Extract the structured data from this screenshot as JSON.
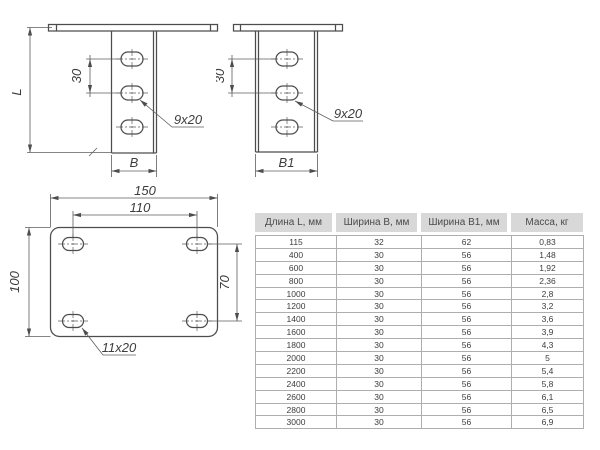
{
  "drawings": {
    "side": {
      "dim_length": "L",
      "dim_hole_spacing": "30",
      "dim_width": "B",
      "slot_size": "9x20"
    },
    "front": {
      "dim_hole_spacing": "30",
      "dim_width": "B1",
      "slot_size": "9x20"
    },
    "plan": {
      "dim_overall_width": "150",
      "dim_hole_span_h": "110",
      "dim_overall_height": "100",
      "dim_hole_span_v": "70",
      "slot_size": "11x20"
    }
  },
  "table": {
    "columns": [
      "Длина L, мм",
      "Ширина B, мм",
      "Ширина B1, мм",
      "Масса, кг"
    ],
    "rows": [
      [
        "115",
        "32",
        "62",
        "0,83"
      ],
      [
        "400",
        "30",
        "56",
        "1,48"
      ],
      [
        "600",
        "30",
        "56",
        "1,92"
      ],
      [
        "800",
        "30",
        "56",
        "2,36"
      ],
      [
        "1000",
        "30",
        "56",
        "2,8"
      ],
      [
        "1200",
        "30",
        "56",
        "3,2"
      ],
      [
        "1400",
        "30",
        "56",
        "3,6"
      ],
      [
        "1600",
        "30",
        "56",
        "3,9"
      ],
      [
        "1800",
        "30",
        "56",
        "4,3"
      ],
      [
        "2000",
        "30",
        "56",
        "5"
      ],
      [
        "2200",
        "30",
        "56",
        "5,4"
      ],
      [
        "2400",
        "30",
        "56",
        "5,8"
      ],
      [
        "2600",
        "30",
        "56",
        "6,1"
      ],
      [
        "2800",
        "30",
        "56",
        "6,5"
      ],
      [
        "3000",
        "30",
        "56",
        "6,9"
      ]
    ]
  },
  "colors": {
    "line": "#4d4d4d",
    "header_bg": "#d8d8d8",
    "header_text": "#4a4a4a",
    "body_text": "#3c3c3c"
  }
}
